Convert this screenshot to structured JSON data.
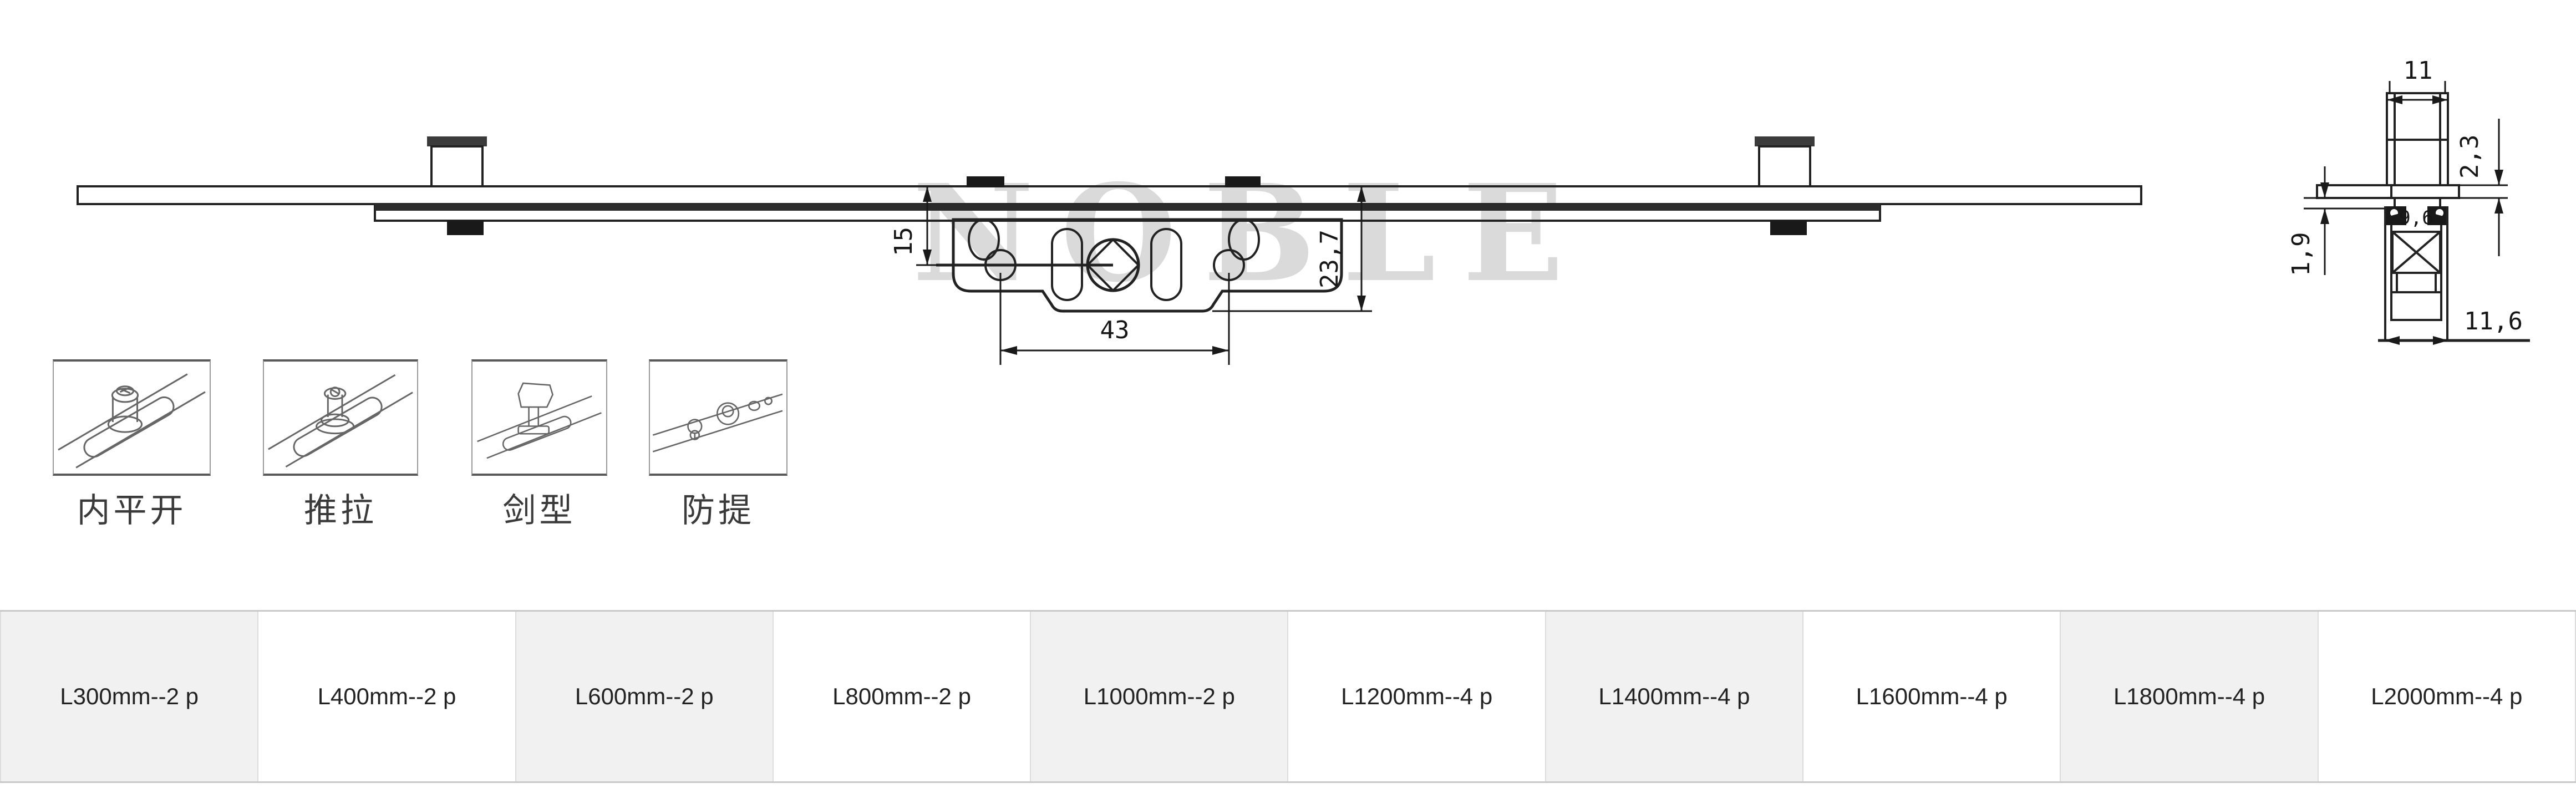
{
  "watermark": {
    "text": "NOBLE"
  },
  "main_view": {
    "title": "espagnolette rod and gearbox front view",
    "dims": {
      "backset": "15",
      "depth": "23,7",
      "screw_spacing": "43"
    }
  },
  "side_view": {
    "title": "rail cross-section",
    "dims": {
      "tongue_width": "11",
      "faceplate_thickness": "2,3",
      "lip_height": "1,9",
      "inner_width": "9,6",
      "overall_width": "11,6"
    }
  },
  "mount_types": [
    {
      "label": "内平开"
    },
    {
      "label": "推拉"
    },
    {
      "label": "剑型"
    },
    {
      "label": "防提"
    }
  ],
  "size_options": {
    "cells": [
      {
        "label": "L300mm--2 p"
      },
      {
        "label": "L400mm--2 p"
      },
      {
        "label": "L600mm--2 p"
      },
      {
        "label": "L800mm--2 p"
      },
      {
        "label": "L1000mm--2 p"
      },
      {
        "label": "L1200mm--4 p"
      },
      {
        "label": "L1400mm--4 p"
      },
      {
        "label": "L1600mm--4 p"
      },
      {
        "label": "L1800mm--4 p"
      },
      {
        "label": "L2000mm--4 p"
      }
    ]
  },
  "colors": {
    "line": "#222222",
    "watermark": "#dadada",
    "cell_alt": "#f1f1f1",
    "cell_bg": "#ffffff",
    "cell_border": "#dcdcdc",
    "text": "#222222"
  }
}
